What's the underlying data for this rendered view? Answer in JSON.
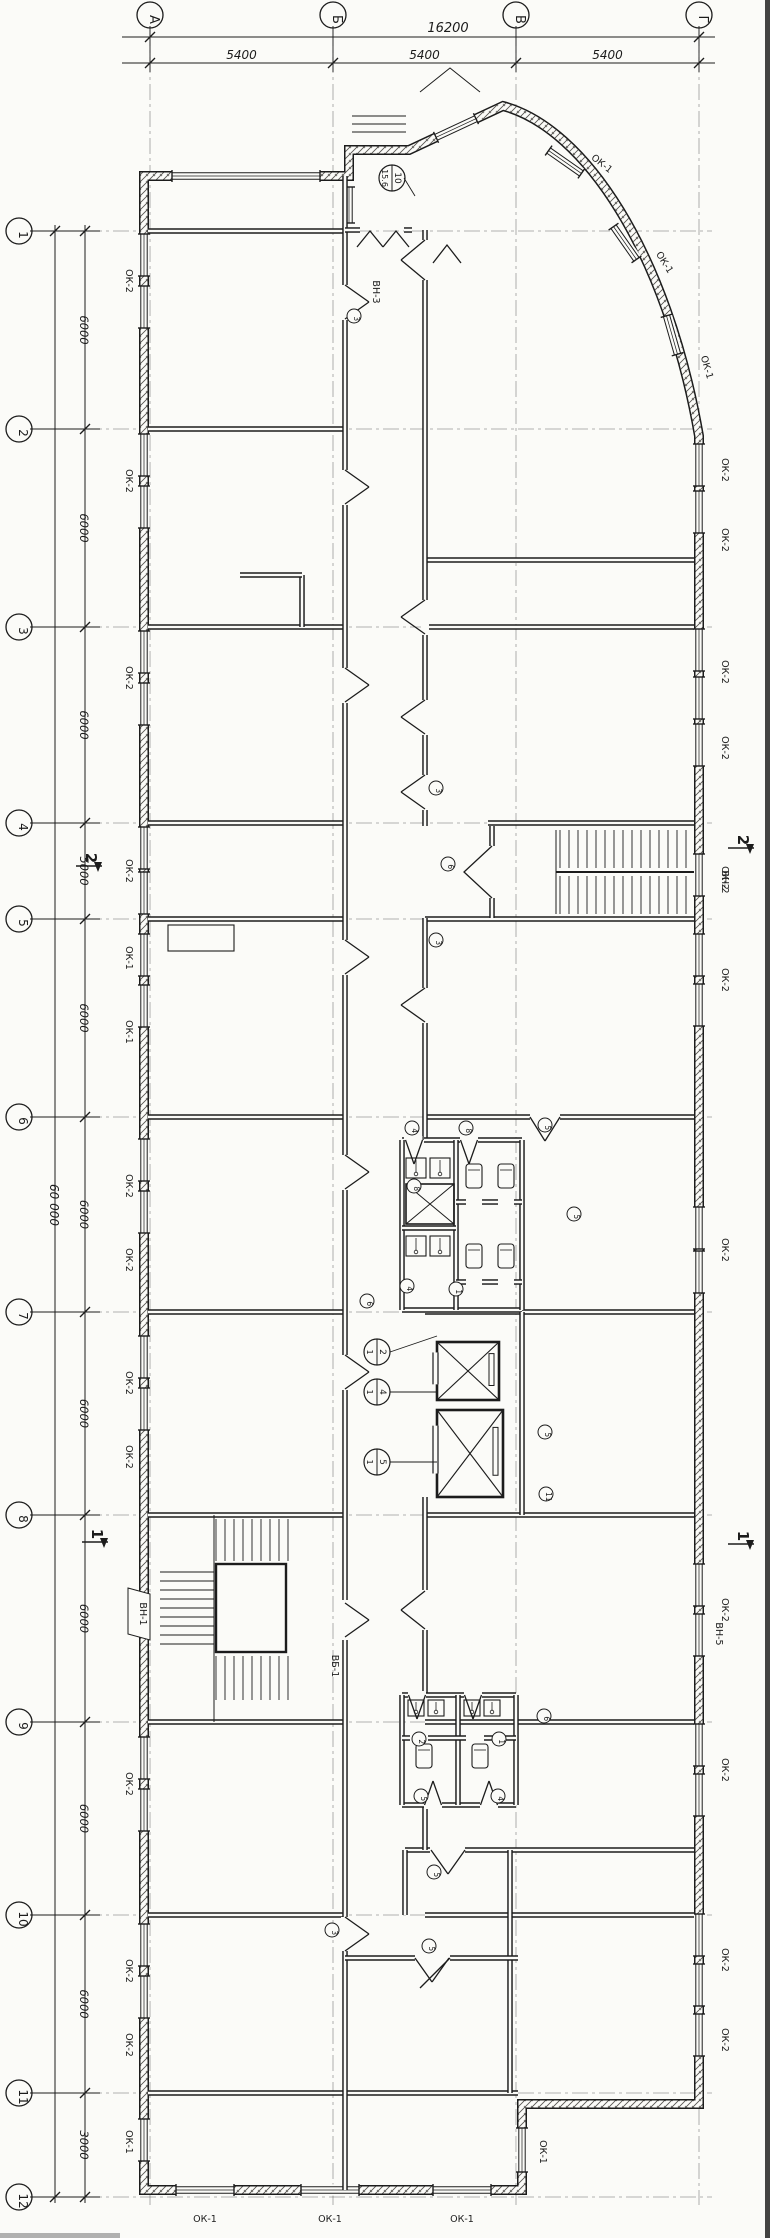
{
  "sheet": {
    "kind": "scanned architectural floor plan",
    "ink_color": "#1c1c1c",
    "paper_color": "#fbfbf8"
  },
  "axes": {
    "top": {
      "letters": [
        "А",
        "Б",
        "В",
        "Г"
      ],
      "overall": "16200",
      "spans": [
        "5400",
        "5400",
        "5400"
      ]
    },
    "left": {
      "numbers": [
        "1",
        "2",
        "3",
        "4",
        "5",
        "6",
        "7",
        "8",
        "9",
        "10",
        "11",
        "12"
      ],
      "overall": "60 000",
      "spans": [
        "6000",
        "6000",
        "6000",
        "5000",
        "6000",
        "6000",
        "6000",
        "6000",
        "6000",
        "6000",
        "3000"
      ]
    }
  },
  "labels": [
    {
      "t": "ОК-2",
      "x": 126,
      "y": 281,
      "r": 90
    },
    {
      "t": "ОК-2",
      "x": 126,
      "y": 481,
      "r": 90
    },
    {
      "t": "ОК-2",
      "x": 126,
      "y": 678,
      "r": 90
    },
    {
      "t": "ОК-2",
      "x": 126,
      "y": 871,
      "r": 90
    },
    {
      "t": "ОК-1",
      "x": 126,
      "y": 958,
      "r": 90
    },
    {
      "t": "ОК-1",
      "x": 126,
      "y": 1032,
      "r": 90
    },
    {
      "t": "ОК-2",
      "x": 126,
      "y": 1186,
      "r": 90
    },
    {
      "t": "ОК-2",
      "x": 126,
      "y": 1260,
      "r": 90
    },
    {
      "t": "ОК-2",
      "x": 126,
      "y": 1383,
      "r": 90
    },
    {
      "t": "ОК-2",
      "x": 126,
      "y": 1457,
      "r": 90
    },
    {
      "t": "ОК-2",
      "x": 126,
      "y": 1784,
      "r": 90
    },
    {
      "t": "ОК-2",
      "x": 126,
      "y": 1971,
      "r": 90
    },
    {
      "t": "ОК-2",
      "x": 126,
      "y": 2045,
      "r": 90
    },
    {
      "t": "ОК-1",
      "x": 126,
      "y": 2142,
      "r": 90
    },
    {
      "t": "ОК-2",
      "x": 722,
      "y": 470,
      "r": 90
    },
    {
      "t": "ОК-2",
      "x": 722,
      "y": 540,
      "r": 90
    },
    {
      "t": "ОК-2",
      "x": 722,
      "y": 672,
      "r": 90
    },
    {
      "t": "ОК-2",
      "x": 722,
      "y": 748,
      "r": 90
    },
    {
      "t": "ОК-2",
      "x": 722,
      "y": 878,
      "r": 90
    },
    {
      "t": "ОК-2",
      "x": 722,
      "y": 980,
      "r": 90
    },
    {
      "t": "ОК-2",
      "x": 722,
      "y": 1250,
      "r": 90
    },
    {
      "t": "ОК-2",
      "x": 722,
      "y": 1610,
      "r": 90
    },
    {
      "t": "ОК-2",
      "x": 722,
      "y": 1770,
      "r": 90
    },
    {
      "t": "ОК-2",
      "x": 722,
      "y": 1960,
      "r": 90
    },
    {
      "t": "ОК-2",
      "x": 722,
      "y": 2040,
      "r": 90
    },
    {
      "t": "ОК-1",
      "x": 600,
      "y": 166,
      "r": 38
    },
    {
      "t": "ОК-1",
      "x": 662,
      "y": 264,
      "r": 58
    },
    {
      "t": "ОК-1",
      "x": 704,
      "y": 368,
      "r": 74
    },
    {
      "t": "ОК-1",
      "x": 205,
      "y": 2222,
      "r": 0
    },
    {
      "t": "ОК-1",
      "x": 330,
      "y": 2222,
      "r": 0
    },
    {
      "t": "ОК-1",
      "x": 462,
      "y": 2222,
      "r": 0
    },
    {
      "t": "ОК-1",
      "x": 540,
      "y": 2152,
      "r": 90
    },
    {
      "t": "ВН-3",
      "x": 373,
      "y": 292,
      "r": 90
    },
    {
      "t": "ВН-2",
      "x": 722,
      "y": 882,
      "r": 90
    },
    {
      "t": "ВН-5",
      "x": 716,
      "y": 1634,
      "r": 90
    },
    {
      "t": "ВН-1",
      "x": 140,
      "y": 1614,
      "r": 90
    },
    {
      "t": "ВБ-1",
      "x": 332,
      "y": 1666,
      "r": 90
    }
  ],
  "door_marks": [
    {
      "t": "3",
      "x": 354,
      "y": 316
    },
    {
      "t": "3",
      "x": 436,
      "y": 788
    },
    {
      "t": "6",
      "x": 448,
      "y": 864
    },
    {
      "t": "3",
      "x": 436,
      "y": 940
    },
    {
      "t": "4",
      "x": 412,
      "y": 1128
    },
    {
      "t": "8",
      "x": 466,
      "y": 1128
    },
    {
      "t": "5",
      "x": 545,
      "y": 1125
    },
    {
      "t": "8",
      "x": 414,
      "y": 1186
    },
    {
      "t": "5",
      "x": 574,
      "y": 1214
    },
    {
      "t": "4",
      "x": 407,
      "y": 1286
    },
    {
      "t": "1",
      "x": 456,
      "y": 1289
    },
    {
      "t": "6",
      "x": 367,
      "y": 1301
    },
    {
      "t": "5",
      "x": 545,
      "y": 1432
    },
    {
      "t": "11",
      "x": 546,
      "y": 1494
    },
    {
      "t": "6",
      "x": 544,
      "y": 1716
    },
    {
      "t": "2",
      "x": 419,
      "y": 1739
    },
    {
      "t": "1",
      "x": 499,
      "y": 1739
    },
    {
      "t": "5",
      "x": 421,
      "y": 1796
    },
    {
      "t": "4",
      "x": 498,
      "y": 1796
    },
    {
      "t": "5",
      "x": 434,
      "y": 1872
    },
    {
      "t": "3",
      "x": 332,
      "y": 1930
    },
    {
      "t": "5",
      "x": 429,
      "y": 1946
    }
  ],
  "room_tags": [
    {
      "a": "10",
      "b": "15.6",
      "x": 392,
      "y": 178
    },
    {
      "a": "2",
      "b": "1",
      "x": 377,
      "y": 1352
    },
    {
      "a": "4",
      "b": "1",
      "x": 377,
      "y": 1392
    },
    {
      "a": "5",
      "b": "1",
      "x": 377,
      "y": 1462
    }
  ],
  "sections": [
    {
      "t": "2",
      "x": 92,
      "y": 866
    },
    {
      "t": "2",
      "x": 744,
      "y": 848
    },
    {
      "t": "1",
      "x": 98,
      "y": 1542
    },
    {
      "t": "1",
      "x": 744,
      "y": 1544
    }
  ]
}
